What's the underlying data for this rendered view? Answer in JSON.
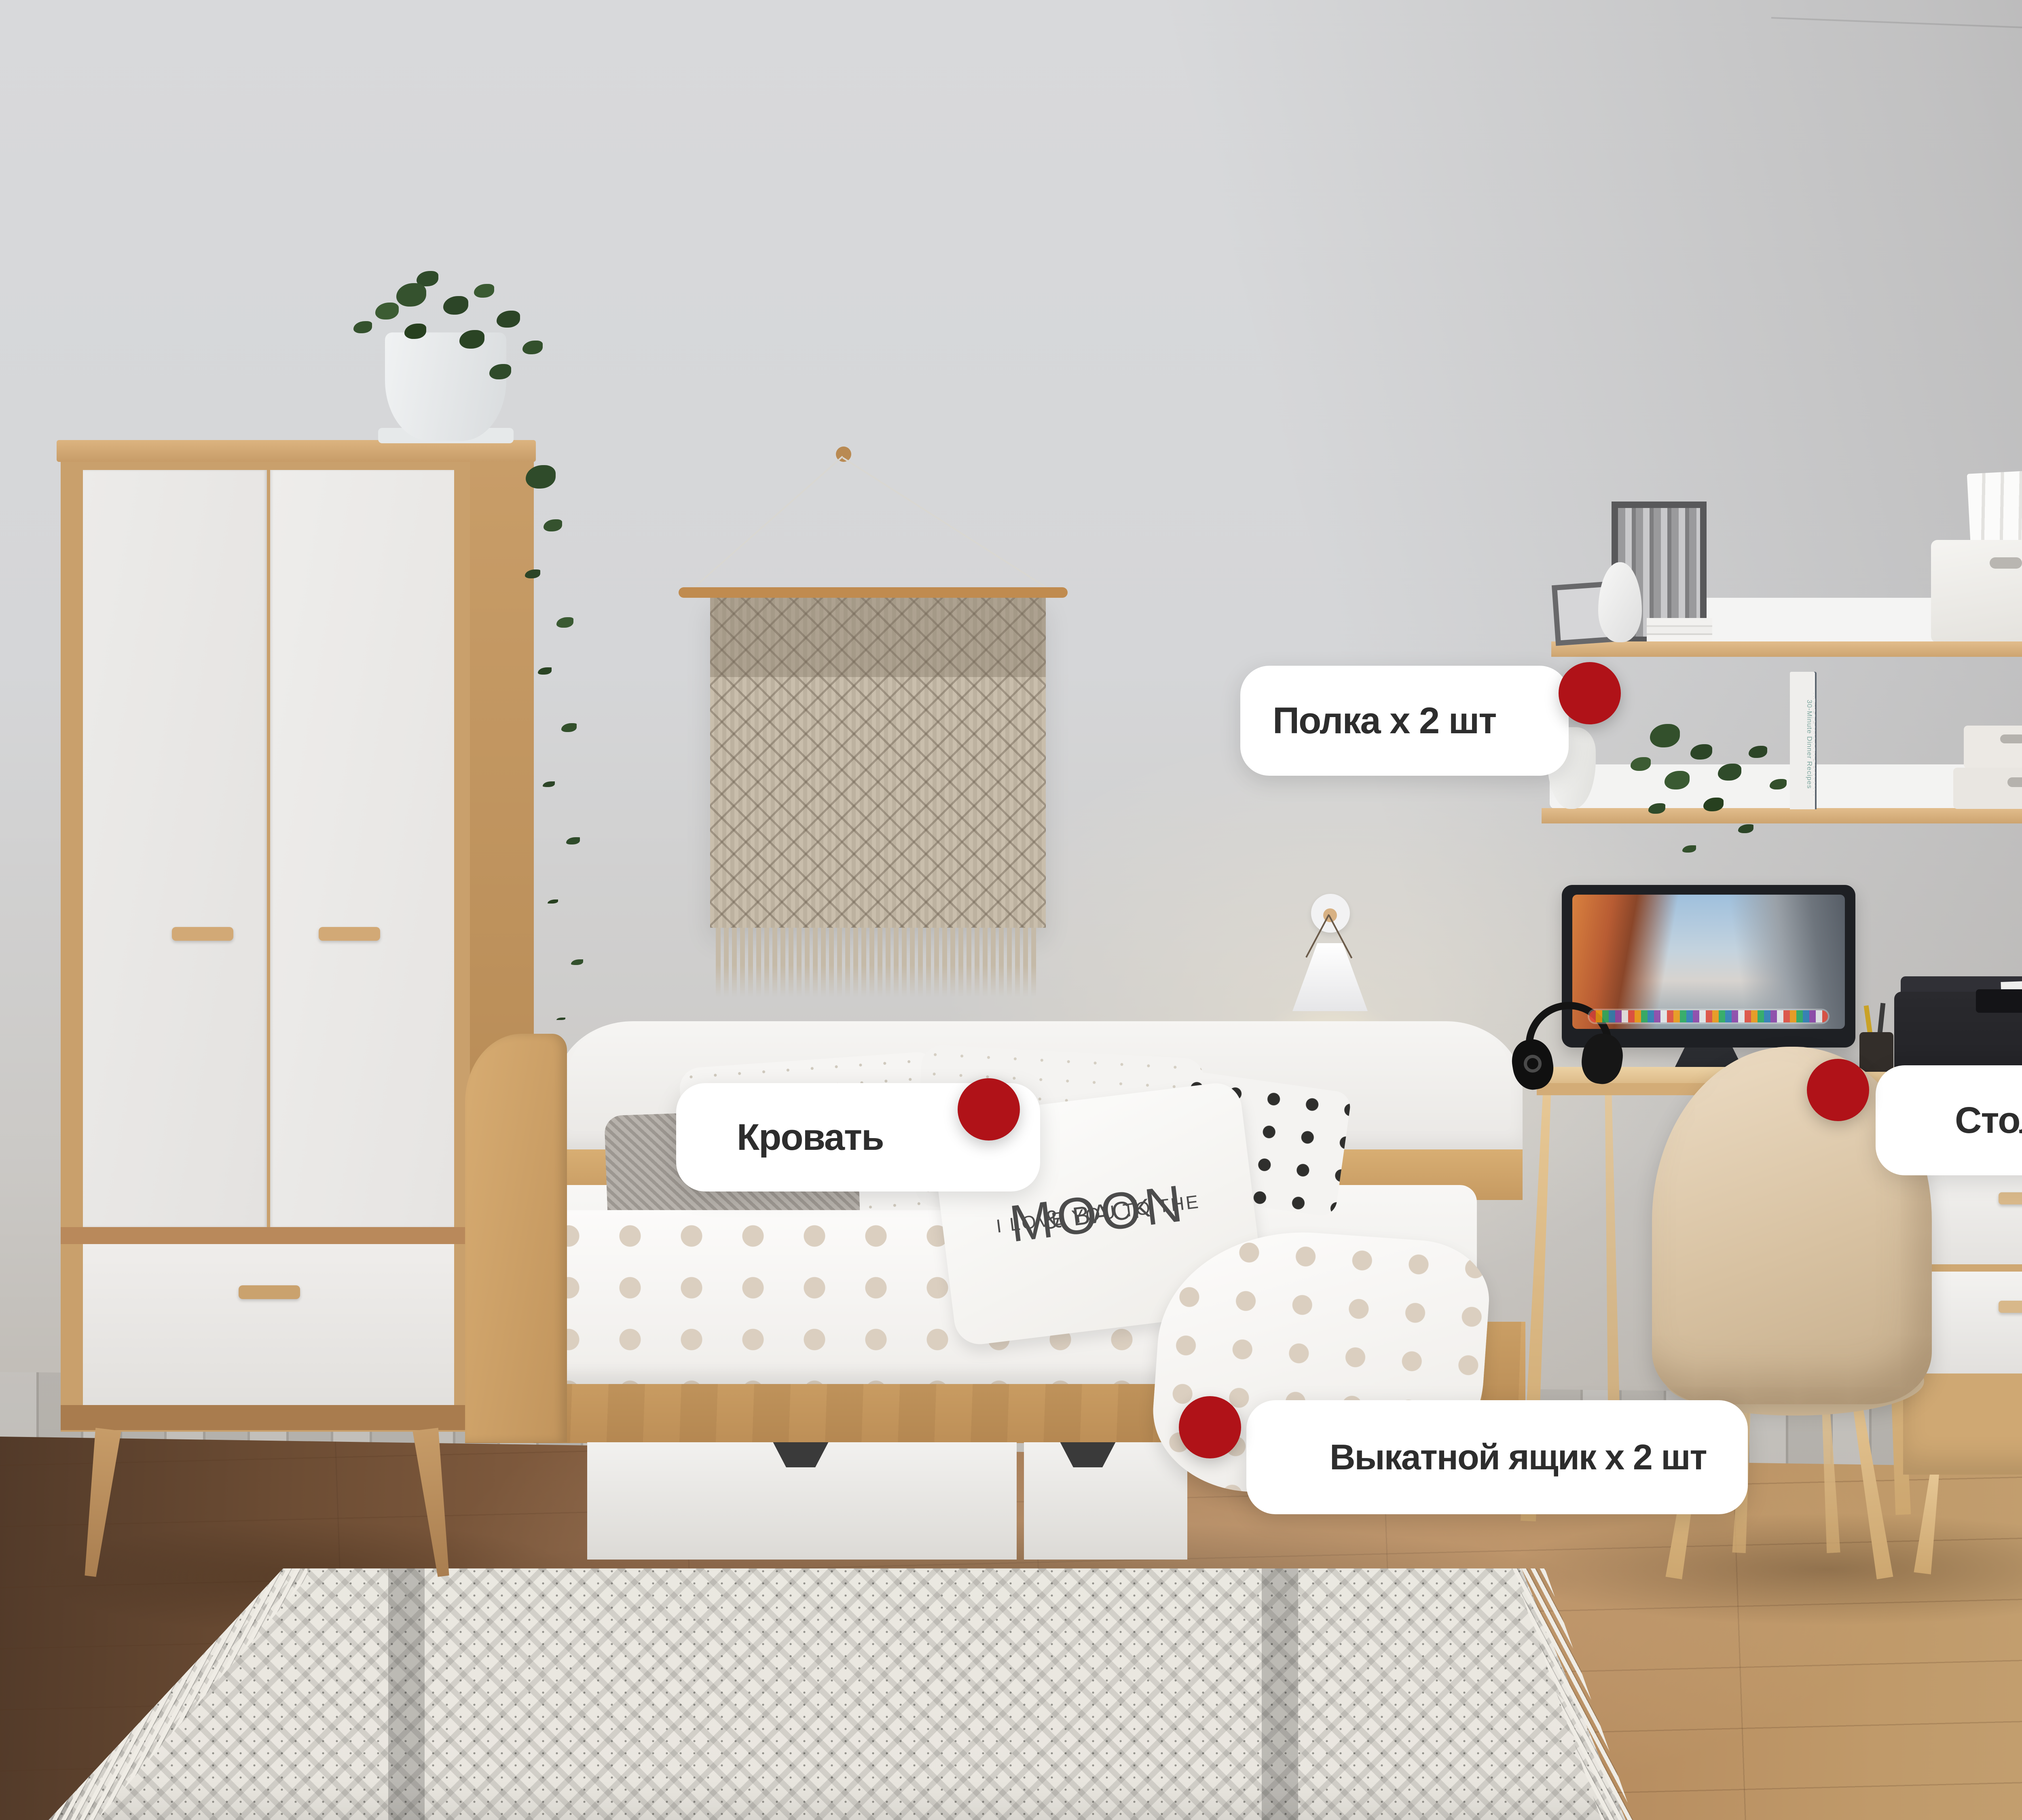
{
  "labels": {
    "shelf": {
      "text": "Полка x 2 шт"
    },
    "bed": {
      "text": "Кровать"
    },
    "desk": {
      "text": "Стол письменный"
    },
    "drawer": {
      "text": "Выкатной ящик x 2 шт"
    }
  },
  "colors": {
    "accent_red": "#B01218",
    "pill_background": "#FFFFFF",
    "label_text": "#2D2D2D",
    "wood": "#CFA873",
    "wall": "#D6D7D9"
  },
  "printer": {
    "brand": "Canon"
  },
  "pillow": {
    "line1": "I LOVE YOU TO THE",
    "line2": "MOON",
    "line3": "& BACK"
  },
  "shelves": {
    "books": [
      "UNWRAP UVW MAP BY M.AX",
      "QUADRIFY MESH BY M.AX",
      "TURBOSMOOTH BY M.AX",
      "QUADRIFY MESH BY M.AX",
      "UNWRAP UVW MAP BY M.AX",
      "30-Minute Dinner Recipes"
    ]
  }
}
